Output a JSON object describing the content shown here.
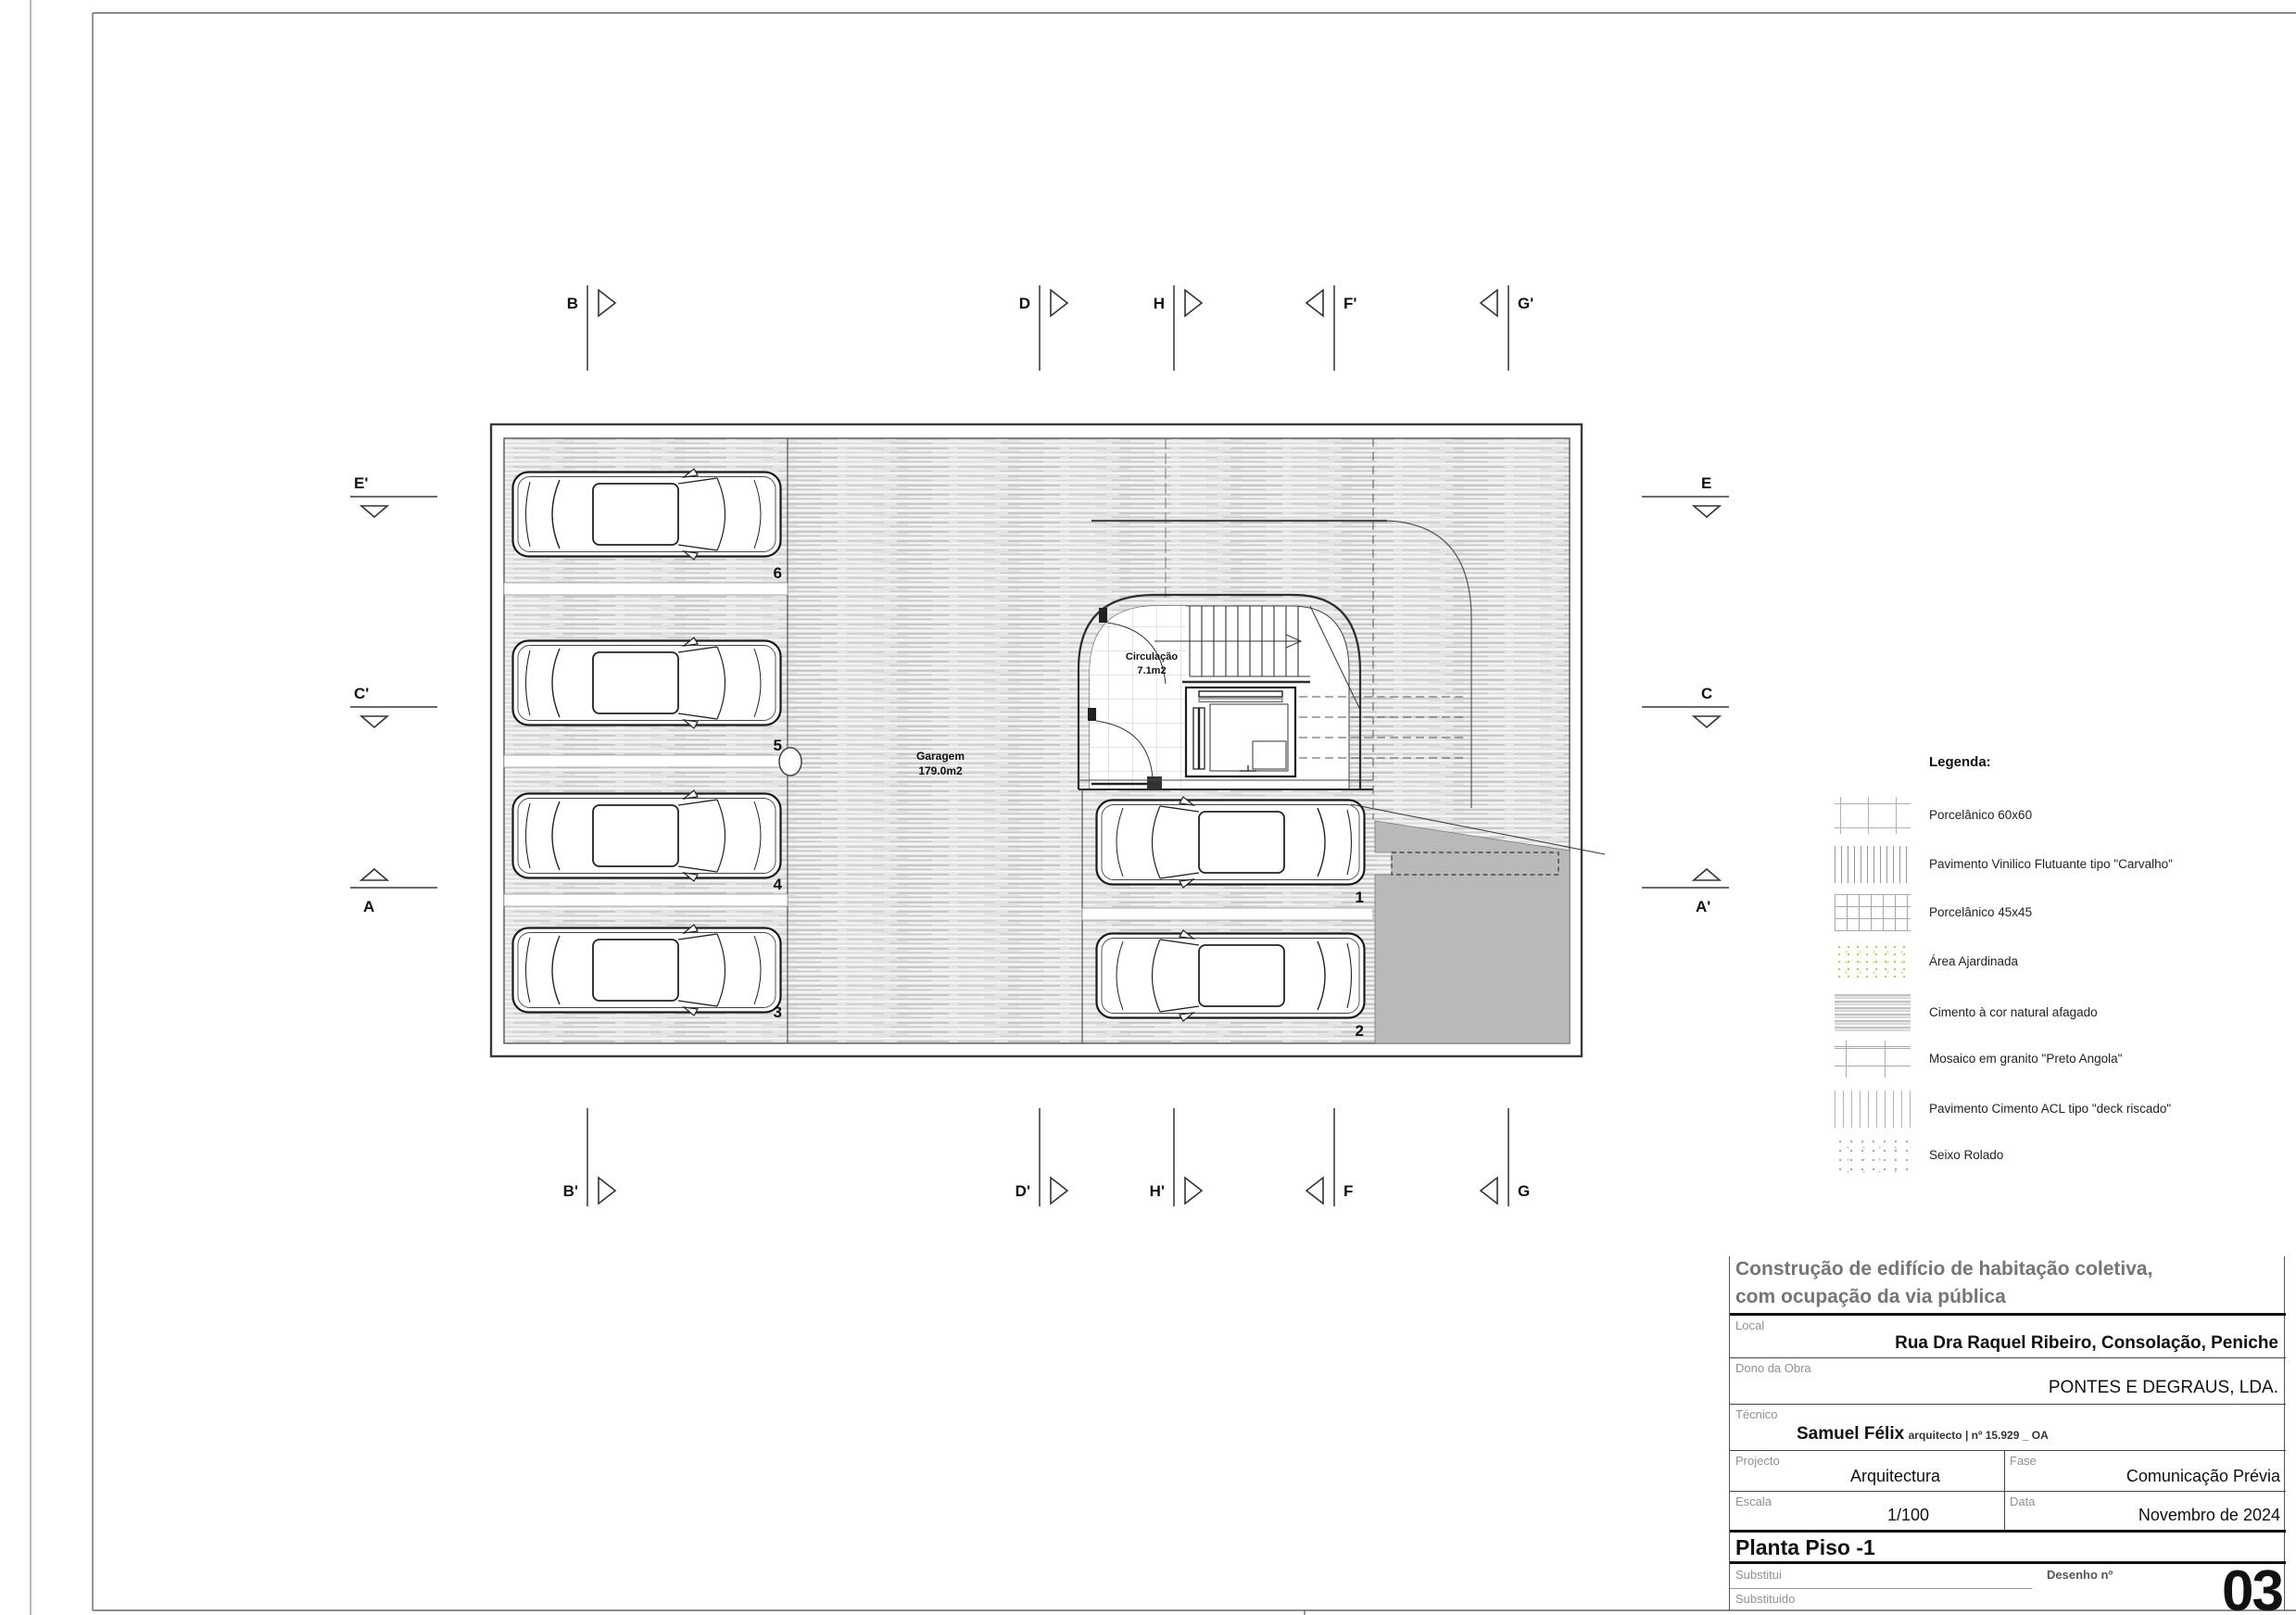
{
  "plan": {
    "garagem": {
      "name": "Garagem",
      "area": "179.0m2"
    },
    "circulacao": {
      "name": "Circulação",
      "area": "7.1m2"
    },
    "spots": {
      "p1": "1",
      "p2": "2",
      "p3": "3",
      "p4": "4",
      "p5": "5",
      "p6": "6"
    }
  },
  "markers": {
    "top": [
      {
        "label": "B"
      },
      {
        "label": "D"
      },
      {
        "label": "H"
      },
      {
        "label": "F'"
      },
      {
        "label": "G'"
      }
    ],
    "bottom": [
      {
        "label": "B'"
      },
      {
        "label": "D'"
      },
      {
        "label": "H'"
      },
      {
        "label": "F"
      },
      {
        "label": "G"
      }
    ],
    "left": [
      {
        "label": "E'"
      },
      {
        "label": "C'"
      },
      {
        "label": "A"
      }
    ],
    "right": [
      {
        "label": "E"
      },
      {
        "label": "C"
      },
      {
        "label": "A'"
      }
    ]
  },
  "legend": {
    "title": "Legenda:",
    "items": [
      {
        "label": "Porcelânico 60x60",
        "swatch": "grid-sparse"
      },
      {
        "label": "Pavimento Vinilico Flutuante tipo \"Carvalho\"",
        "swatch": "vertical-lines-dense"
      },
      {
        "label": "Porcelânico 45x45",
        "swatch": "grid-dense"
      },
      {
        "label": "Área Ajardinada",
        "swatch": "green-speckle"
      },
      {
        "label": "Cimento à cor natural afagado",
        "swatch": "gray-streaks"
      },
      {
        "label": "Mosaico em granito \"Preto Angola\"",
        "swatch": "grid-wide"
      },
      {
        "label": "Pavimento Cimento ACL tipo \"deck riscado\"",
        "swatch": "vertical-lines-light"
      },
      {
        "label": "Seixo Rolado",
        "swatch": "gray-speckle"
      }
    ],
    "accent_green": "#b7cf54",
    "line_gray": "#a8a8a8"
  },
  "title_block": {
    "project_title_line1": "Construção de edifício de habitação coletiva,",
    "project_title_line2": "com ocupação da via pública",
    "local_label": "Local",
    "local_value": "Rua Dra Raquel Ribeiro, Consolação, Peniche",
    "dono_label": "Dono da Obra",
    "dono_value": "PONTES E DEGRAUS, LDA.",
    "tecnico_label": "Técnico",
    "tecnico_name": "Samuel Félix",
    "tecnico_details": "arquitecto | nº 15.929 _ OA",
    "projecto_label": "Projecto",
    "projecto_value": "Arquitectura",
    "fase_label": "Fase",
    "fase_value": "Comunicação Prévia",
    "escala_label": "Escala",
    "escala_value": "1/100",
    "data_label": "Data",
    "data_value": "Novembro de 2024",
    "drawing_title": "Planta Piso -1",
    "substitui_label": "Substitui",
    "substituido_label": "Substituido",
    "desenho_label": "Desenho nº",
    "desenho_value": "03"
  }
}
